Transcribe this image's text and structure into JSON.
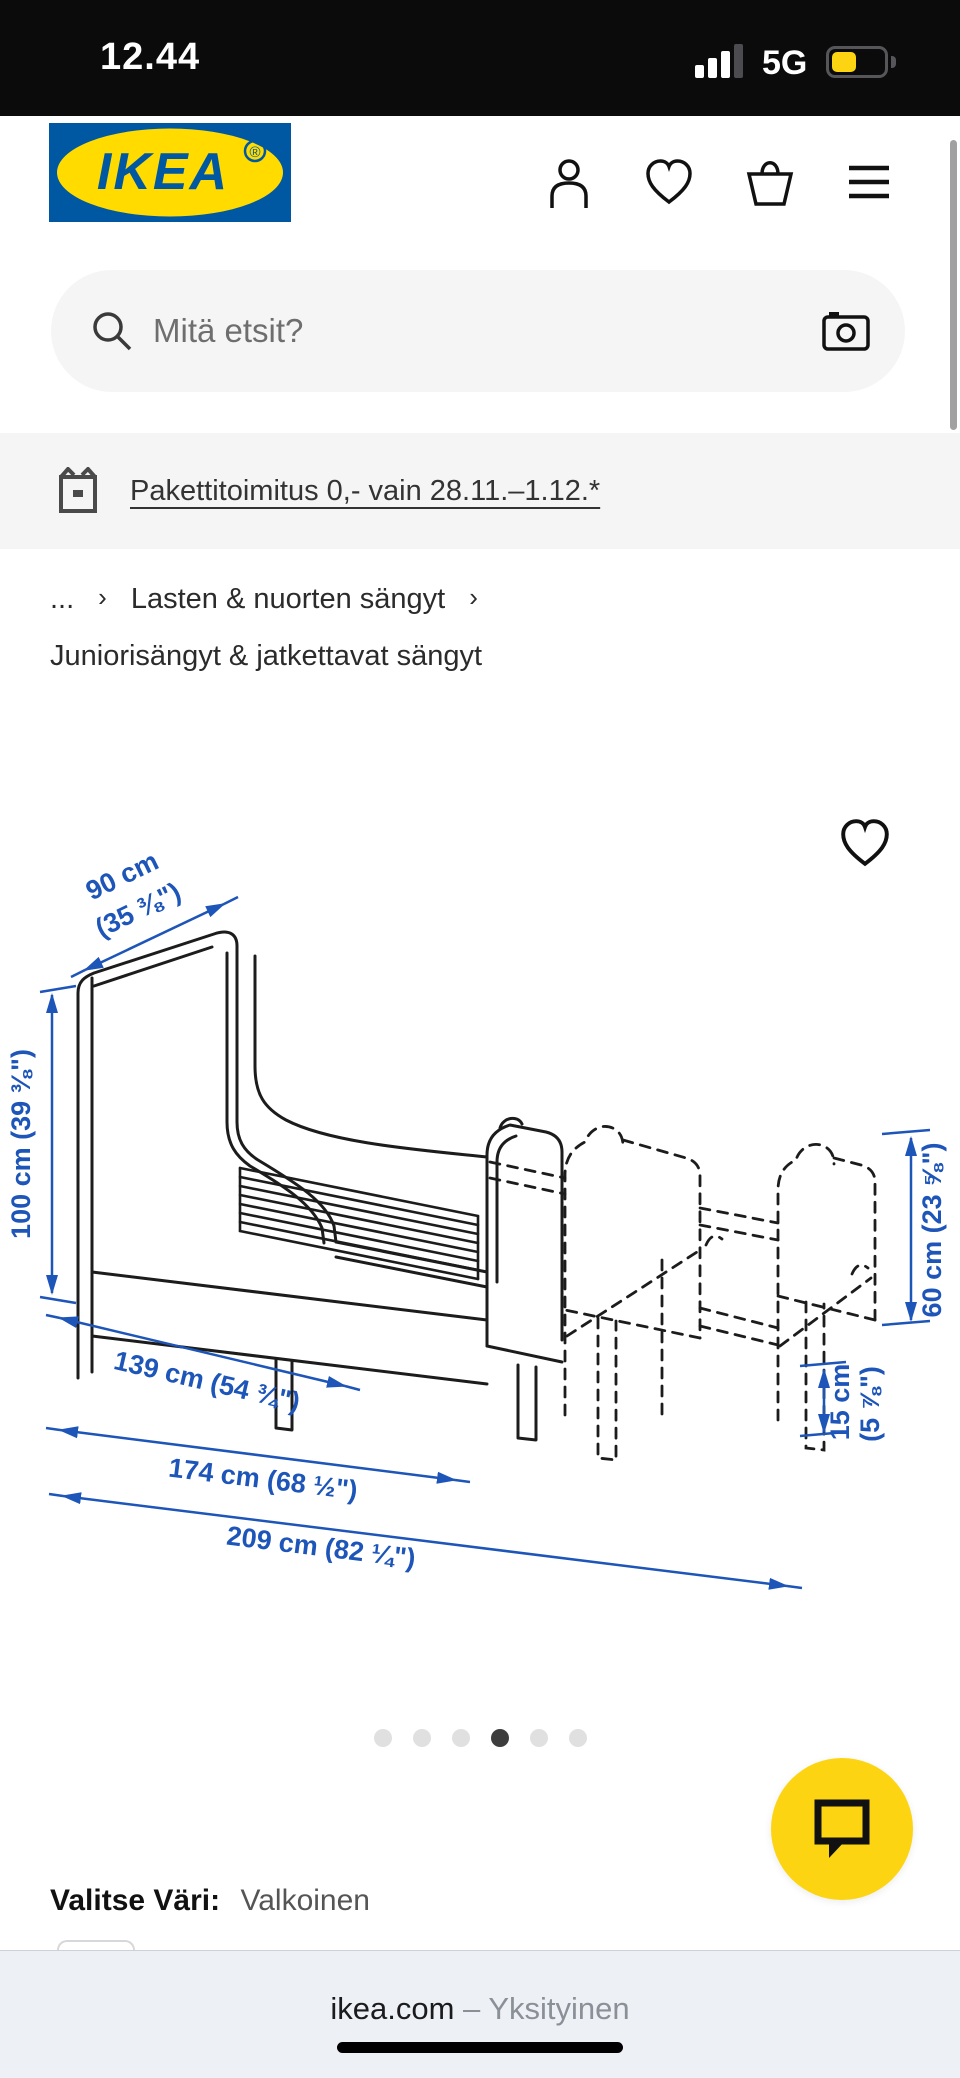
{
  "status_bar": {
    "time": "12.44",
    "network": "5G"
  },
  "header": {
    "logo_text": "IKEA",
    "logo_registered": "®",
    "icons": {
      "account": "person-icon",
      "favorites": "heart-icon",
      "cart": "basket-icon",
      "menu": "hamburger-icon"
    }
  },
  "search": {
    "placeholder": "Mitä etsit?",
    "icons": {
      "left": "magnifier-icon",
      "right": "camera-icon"
    }
  },
  "promo_banner": {
    "text": "Pakettitoimitus 0,- vain 28.11.–1.12.*",
    "icon": "package-icon"
  },
  "breadcrumb": {
    "ellipsis": "...",
    "separator": "›",
    "level1": "Lasten & nuorten sängyt",
    "level2": "Juniorisängyt & jatkettavat sängyt"
  },
  "product_image": {
    "type": "technical dimension drawing of extendable bed",
    "dimensions": {
      "width_line1": "90 cm",
      "width_line2": "(35 ⅜\")",
      "height": "100 cm (39 ⅜\")",
      "length_min": "139 cm (54 ¾\")",
      "length_mid": "174 cm (68 ½\")",
      "length_max": "209 cm (82 ¼\")",
      "end_panel_height": "60 cm (23 ⅝\")",
      "extension_line1": "15 cm",
      "extension_line2": "(5 ⅞\")"
    },
    "carousel": {
      "dots_total": 6,
      "active_dot": 4
    },
    "favorite_icon": "heart-icon"
  },
  "chat": {
    "icon": "speech-bubble-icon"
  },
  "color_selector": {
    "label": "Valitse Väri:",
    "value": "Valkoinen"
  },
  "browser_bar": {
    "site": "ikea.com",
    "separator": "–",
    "mode": "Yksityinen"
  },
  "colors": {
    "ikea_blue": "#0058A3",
    "ikea_yellow": "#FFDB00",
    "dim_blue": "#1d55b8",
    "chat_yellow": "#fcd411",
    "active_dot": "#3d3d3d",
    "inactive_dot": "#e0e0e0"
  }
}
